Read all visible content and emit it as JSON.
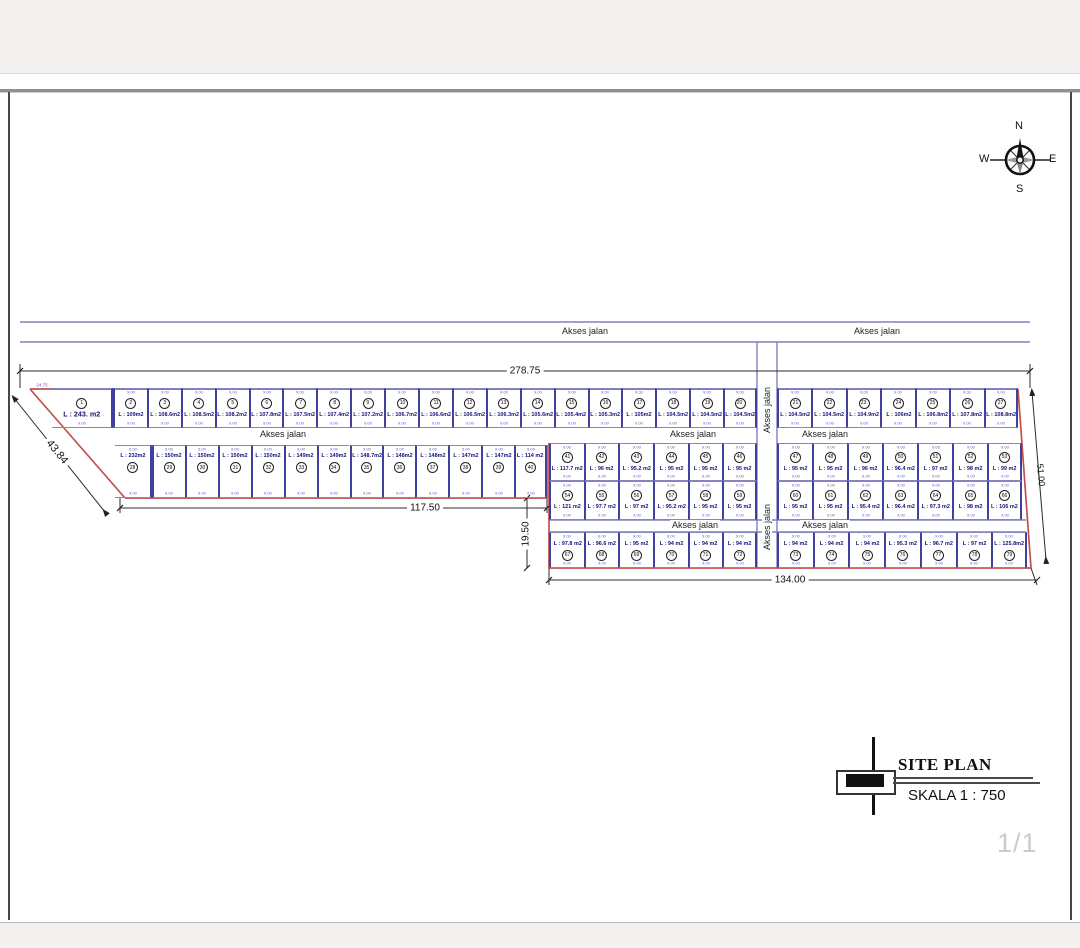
{
  "app": {
    "page_indicator": "1/1"
  },
  "compass": {
    "north": "N",
    "east": "E",
    "south": "S",
    "west": "W"
  },
  "title_block": {
    "title": "SITE PLAN",
    "scale_label": "SKALA 1 : 750"
  },
  "road_label": "Akses jalan",
  "dimensions": {
    "top_width": "278.75",
    "left_block_bottom": "117.50",
    "right_block_bottom": "134.00",
    "left_diagonal": "43.84",
    "middle_vertical": "19.50",
    "right_diagonal": "51.00",
    "plot1_top": "24.75",
    "typical_cell_width": "9.00"
  },
  "colors": {
    "boundary_red": "#c0504d",
    "parcel_purple": "#4040a0",
    "road_purple": "#8080bf",
    "area_text_navy": "#14147a"
  },
  "plots": {
    "row_top_left": [
      {
        "no": 1,
        "area": "L : 243. m2"
      },
      {
        "no": 2,
        "area": "L : 109m2"
      },
      {
        "no": 3,
        "area": "L : 108.6m2"
      },
      {
        "no": 4,
        "area": "L : 108.5m2"
      },
      {
        "no": 5,
        "area": "L : 108.2m2"
      },
      {
        "no": 6,
        "area": "L : 107.8m2"
      },
      {
        "no": 7,
        "area": "L : 107.5m2"
      },
      {
        "no": 8,
        "area": "L : 107.4m2"
      },
      {
        "no": 9,
        "area": "L : 107.2m2"
      },
      {
        "no": 10,
        "area": "L : 106.7m2"
      },
      {
        "no": 11,
        "area": "L : 106.6m2"
      },
      {
        "no": 12,
        "area": "L : 106.5m2"
      },
      {
        "no": 13,
        "area": "L : 106.3m2"
      },
      {
        "no": 14,
        "area": "L : 105.6m2"
      },
      {
        "no": 15,
        "area": "L : 105.4m2"
      },
      {
        "no": 16,
        "area": "L : 105.3m2"
      },
      {
        "no": 17,
        "area": "L : 105m2"
      },
      {
        "no": 18,
        "area": "L : 104.5m2"
      },
      {
        "no": 19,
        "area": "L : 104.5m2"
      },
      {
        "no": 20,
        "area": "L : 104.5m2"
      }
    ],
    "row_top_right": [
      {
        "no": 21,
        "area": "L : 104.5m2"
      },
      {
        "no": 22,
        "area": "L : 104.5m2"
      },
      {
        "no": 23,
        "area": "L : 104.9m2"
      },
      {
        "no": 24,
        "area": "L : 106m2"
      },
      {
        "no": 25,
        "area": "L : 106.8m2"
      },
      {
        "no": 26,
        "area": "L : 107.8m2"
      },
      {
        "no": 27,
        "area": "L : 108.8m2"
      }
    ],
    "row_second_left": [
      {
        "no": 28,
        "area": "L : 232m2"
      },
      {
        "no": 29,
        "area": "L : 150m2"
      },
      {
        "no": 30,
        "area": "L : 150m2"
      },
      {
        "no": 31,
        "area": "L : 150m2"
      },
      {
        "no": 32,
        "area": "L : 150m2"
      },
      {
        "no": 33,
        "area": "L : 149m2"
      },
      {
        "no": 34,
        "area": "L : 149m2"
      },
      {
        "no": 35,
        "area": "L : 148.7m2"
      },
      {
        "no": 36,
        "area": "L : 148m2"
      },
      {
        "no": 37,
        "area": "L : 148m2"
      },
      {
        "no": 38,
        "area": "L : 147m2"
      },
      {
        "no": 39,
        "area": "L : 147m2"
      },
      {
        "no": 40,
        "area": "L : 114 m2"
      }
    ],
    "row_mid_upper": [
      {
        "no": 41,
        "area": "L : 117.7 m2"
      },
      {
        "no": 42,
        "area": "L : 96 m2"
      },
      {
        "no": 43,
        "area": "L : 95.2 m2"
      },
      {
        "no": 44,
        "area": "L : 95 m2"
      },
      {
        "no": 45,
        "area": "L : 95 m2"
      },
      {
        "no": 46,
        "area": "L : 95 m2"
      },
      {
        "no": 47,
        "area": "L : 95 m2"
      },
      {
        "no": 48,
        "area": "L : 95 m2"
      },
      {
        "no": 49,
        "area": "L : 96 m2"
      },
      {
        "no": 50,
        "area": "L : 96.4 m2"
      },
      {
        "no": 51,
        "area": "L : 97 m2"
      },
      {
        "no": 52,
        "area": "L : 98 m2"
      },
      {
        "no": 53,
        "area": "L : 99 m2"
      }
    ],
    "row_mid_lower": [
      {
        "no": 54,
        "area": "L : 121 m2"
      },
      {
        "no": 55,
        "area": "L : 97.7 m2"
      },
      {
        "no": 56,
        "area": "L : 97 m2"
      },
      {
        "no": 57,
        "area": "L : 95.2 m2"
      },
      {
        "no": 58,
        "area": "L : 95 m2"
      },
      {
        "no": 59,
        "area": "L : 95 m2"
      },
      {
        "no": 60,
        "area": "L : 95 m2"
      },
      {
        "no": 61,
        "area": "L : 95 m2"
      },
      {
        "no": 62,
        "area": "L : 95.4 m2"
      },
      {
        "no": 63,
        "area": "L : 96.4 m2"
      },
      {
        "no": 64,
        "area": "L : 97.3 m2"
      },
      {
        "no": 65,
        "area": "L : 98 m2"
      },
      {
        "no": 66,
        "area": "L : 106 m2"
      }
    ],
    "row_bottom": [
      {
        "no": 67,
        "area": "L : 97.8 m2"
      },
      {
        "no": 68,
        "area": "L : 96.6 m2"
      },
      {
        "no": 69,
        "area": "L : 95 m2"
      },
      {
        "no": 70,
        "area": "L : 94 m2"
      },
      {
        "no": 71,
        "area": "L : 94 m2"
      },
      {
        "no": 72,
        "area": "L : 94 m2"
      },
      {
        "no": 73,
        "area": "L : 94 m2"
      },
      {
        "no": 74,
        "area": "L : 94 m2"
      },
      {
        "no": 75,
        "area": "L : 94 m2"
      },
      {
        "no": 76,
        "area": "L : 95.3 m2"
      },
      {
        "no": 77,
        "area": "L : 96.7 m2"
      },
      {
        "no": 78,
        "area": "L : 97 m2"
      },
      {
        "no": 79,
        "area": "L : 125.8m2"
      }
    ]
  }
}
